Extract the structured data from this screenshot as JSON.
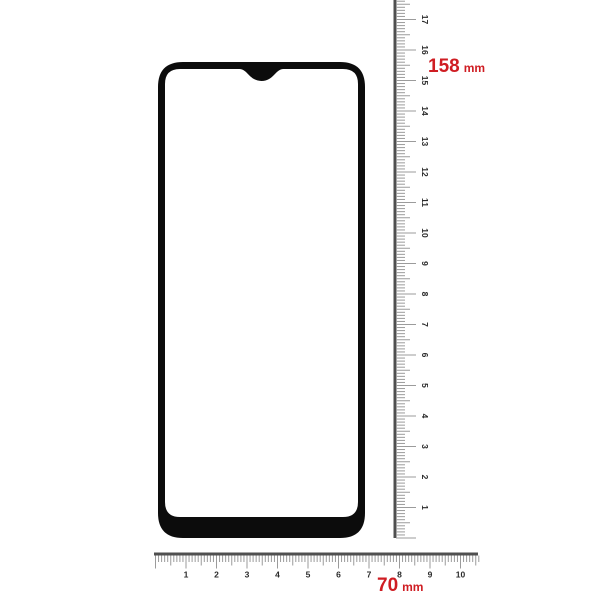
{
  "product": {
    "subject": "tempered-glass-screen-protector-outline",
    "height_measurement": {
      "value": "158",
      "unit": "mm"
    },
    "width_measurement": {
      "value": "70",
      "unit": "mm"
    }
  },
  "vertical_ruler": {
    "unit": "cm",
    "tick_numbers": [
      17,
      16,
      15,
      14,
      13,
      12,
      11,
      10,
      9,
      8,
      7,
      6,
      5,
      4,
      3,
      2,
      1
    ]
  },
  "horizontal_ruler": {
    "unit": "cm",
    "tick_numbers": [
      1,
      2,
      3,
      4,
      5,
      6,
      7,
      8,
      9,
      10
    ]
  },
  "colors": {
    "background": "#ffffff",
    "measurement_text": "#cf1d23",
    "glass_border": "#0c0c0c",
    "ruler_edge": "#4f4f4f",
    "ruler_tick": "#9b9b9b",
    "ruler_number": "#2b2b2b"
  }
}
